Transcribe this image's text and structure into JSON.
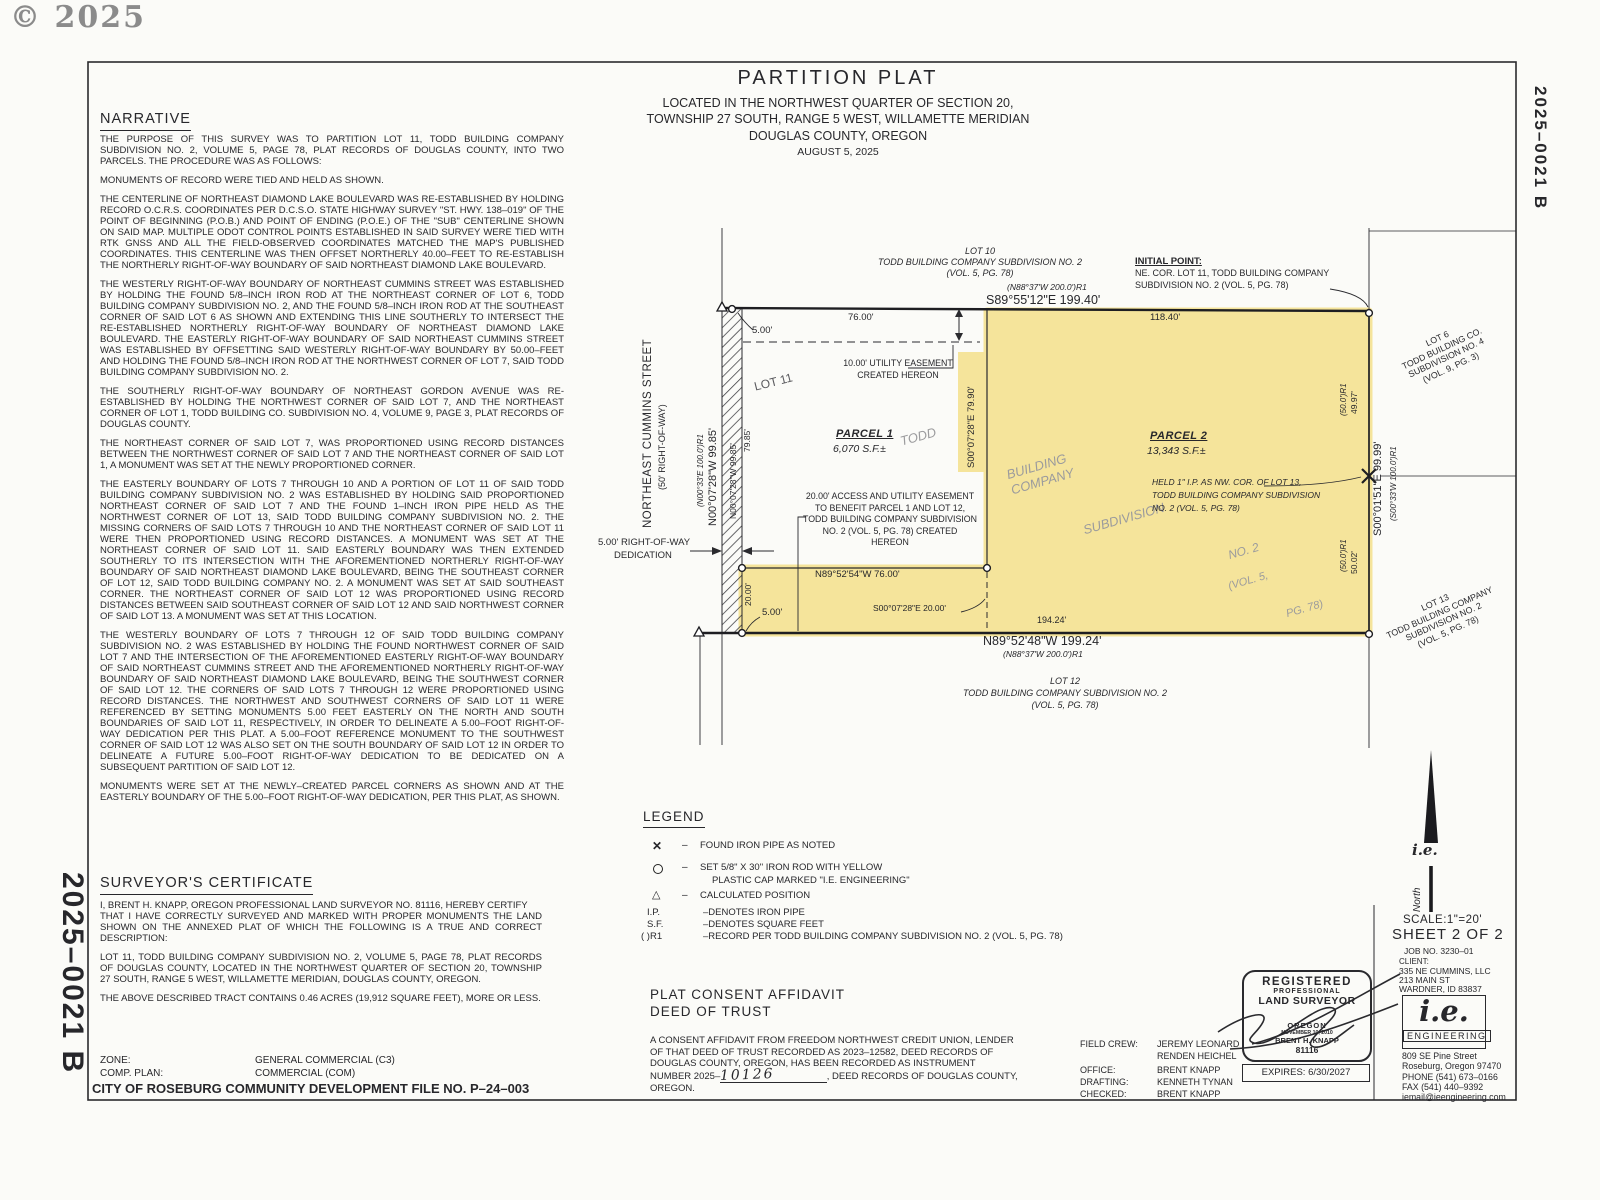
{
  "colors": {
    "highlight": "#f5e49b",
    "ink": "#27272b",
    "paper": "#fbfbf8",
    "watermark": "#9b9b9d"
  },
  "page": {
    "copyright": "© 2025",
    "doc_number_right": "2025–0021 B",
    "doc_number_left": "2025–0021 B"
  },
  "title": {
    "line1": "PARTITION  PLAT",
    "line2": "LOCATED  IN  THE  NORTHWEST  QUARTER  OF  SECTION  20,",
    "line3": "TOWNSHIP  27  SOUTH,  RANGE  5  WEST,  WILLAMETTE  MERIDIAN",
    "line4": "DOUGLAS  COUNTY,  OREGON",
    "date": "AUGUST  5,  2025"
  },
  "narrative": {
    "heading": "NARRATIVE",
    "paragraphs": [
      "THE PURPOSE OF THIS SURVEY WAS TO PARTITION LOT 11, TODD BUILDING COMPANY SUBDIVISION NO. 2, VOLUME 5, PAGE 78, PLAT RECORDS OF DOUGLAS COUNTY, INTO TWO PARCELS. THE PROCEDURE WAS AS FOLLOWS:",
      "MONUMENTS OF RECORD WERE TIED AND HELD AS SHOWN.",
      "THE CENTERLINE OF NORTHEAST DIAMOND LAKE BOULEVARD WAS RE-ESTABLISHED BY HOLDING RECORD O.C.R.S. COORDINATES PER D.C.S.O. STATE HIGHWAY SURVEY \"ST. HWY. 138–019\" OF THE POINT OF BEGINNING (P.O.B.) AND POINT OF ENDING (P.O.E.) OF THE \"SUB\" CENTERLINE SHOWN ON SAID MAP.  MULTIPLE ODOT CONTROL POINTS ESTABLISHED IN SAID SURVEY WERE TIED WITH RTK GNSS AND ALL THE FIELD-OBSERVED COORDINATES MATCHED THE MAP'S PUBLISHED COORDINATES.  THIS CENTERLINE WAS THEN OFFSET NORTHERLY 40.00–FEET TO RE-ESTABLISH THE NORTHERLY RIGHT-OF-WAY BOUNDARY OF SAID NORTHEAST DIAMOND LAKE BOULEVARD.",
      "THE WESTERLY RIGHT-OF-WAY BOUNDARY OF NORTHEAST CUMMINS STREET WAS ESTABLISHED BY HOLDING THE FOUND 5/8–INCH IRON ROD AT THE NORTHEAST CORNER OF LOT 6, TODD BUILDING COMPANY SUBDIVISION NO. 2, AND THE FOUND 5/8–INCH IRON ROD AT THE SOUTHEAST CORNER OF SAID LOT 6 AS SHOWN AND EXTENDING THIS LINE SOUTHERLY TO INTERSECT THE RE-ESTABLISHED NORTHERLY RIGHT-OF-WAY BOUNDARY OF NORTHEAST DIAMOND LAKE BOULEVARD.  THE EASTERLY RIGHT-OF-WAY BOUNDARY OF SAID NORTHEAST CUMMINS STREET WAS ESTABLISHED BY OFFSETTING SAID WESTERLY RIGHT-OF-WAY BOUNDARY BY 50.00–FEET AND HOLDING THE FOUND 5/8–INCH IRON ROD AT THE NORTHWEST CORNER OF LOT 7, SAID TODD BUILDING COMPANY SUBDIVISION NO. 2.",
      "THE SOUTHERLY RIGHT-OF-WAY BOUNDARY OF NORTHEAST GORDON AVENUE WAS RE-ESTABLISHED BY HOLDING THE NORTHWEST CORNER OF SAID LOT 7, AND THE NORTHEAST CORNER OF LOT 1, TODD BUILDING CO. SUBDIVISION NO. 4, VOLUME 9, PAGE 3, PLAT RECORDS OF DOUGLAS COUNTY.",
      "THE NORTHEAST CORNER OF SAID LOT 7, WAS PROPORTIONED USING RECORD DISTANCES BETWEEN THE NORTHWEST CORNER OF SAID LOT 7 AND THE NORTHEAST CORNER OF SAID LOT 1, A MONUMENT WAS SET AT THE NEWLY PROPORTIONED CORNER.",
      "THE EASTERLY BOUNDARY OF LOTS 7 THROUGH 10 AND A PORTION OF LOT 11 OF SAID TODD BUILDING COMPANY SUBDIVISION NO. 2 WAS ESTABLISHED BY HOLDING SAID PROPORTIONED NORTHEAST CORNER OF SAID LOT 7 AND THE FOUND 1–INCH IRON PIPE HELD AS THE NORTHWEST CORNER OF LOT 13, SAID TODD BUILDING COMPANY SUBDIVISION NO. 2.  THE MISSING CORNERS OF SAID LOTS 7 THROUGH 10 AND THE NORTHEAST CORNER OF SAID LOT 11 WERE THEN PROPORTIONED USING RECORD DISTANCES.  A MONUMENT WAS SET AT THE NORTHEAST CORNER OF SAID LOT 11.  SAID EASTERLY BOUNDARY WAS THEN EXTENDED SOUTHERLY TO ITS INTERSECTION WITH THE AFOREMENTIONED NORTHERLY RIGHT-OF-WAY BOUNDARY OF SAID NORTHEAST DIAMOND LAKE BOULEVARD, BEING THE SOUTHEAST CORNER OF LOT 12, SAID TODD BUILDING COMPANY NO. 2.  A MONUMENT WAS SET AT SAID SOUTHEAST CORNER.  THE NORTHEAST CORNER OF SAID LOT 12 WAS PROPORTIONED USING RECORD DISTANCES BETWEEN SAID SOUTHEAST CORNER OF SAID LOT 12 AND SAID NORTHWEST CORNER OF SAID LOT 13.  A MONUMENT WAS SET AT THIS LOCATION.",
      "THE WESTERLY BOUNDARY OF LOTS 7 THROUGH 12 OF SAID TODD BUILDING COMPANY SUBDIVISION NO. 2 WAS ESTABLISHED BY HOLDING THE FOUND NORTHWEST CORNER OF SAID LOT 7 AND THE INTERSECTION OF THE AFOREMENTIONED EASTERLY RIGHT-OF-WAY BOUNDARY OF SAID NORTHEAST CUMMINS STREET AND THE AFOREMENTIONED NORTHERLY RIGHT-OF-WAY BOUNDARY OF SAID NORTHEAST DIAMOND LAKE BOULEVARD, BEING THE SOUTHWEST CORNER OF SAID LOT 12.  THE CORNERS OF SAID LOTS 7 THROUGH 12 WERE PROPORTIONED USING RECORD DISTANCES.  THE NORTHWEST AND SOUTHWEST CORNERS OF SAID LOT 11 WERE REFERENCED BY SETTING MONUMENTS 5.00 FEET EASTERLY ON THE NORTH AND SOUTH BOUNDARIES OF SAID LOT 11, RESPECTIVELY, IN ORDER TO DELINEATE A 5.00–FOOT RIGHT-OF-WAY DEDICATION PER THIS PLAT.  A 5.00–FOOT REFERENCE MONUMENT TO THE SOUTHWEST CORNER OF SAID LOT 12 WAS ALSO SET ON THE SOUTH BOUNDARY OF SAID LOT 12 IN ORDER TO DELINEATE A FUTURE 5.00–FOOT RIGHT-OF-WAY DEDICATION TO BE DEDICATED ON A SUBSEQUENT PARTITION OF SAID LOT 12.",
      "MONUMENTS WERE SET AT THE NEWLY–CREATED PARCEL CORNERS AS SHOWN AND AT THE EASTERLY BOUNDARY OF THE 5.00–FOOT RIGHT-OF-WAY DEDICATION, PER THIS PLAT, AS SHOWN."
    ]
  },
  "certificate": {
    "heading": "SURVEYOR'S  CERTIFICATE",
    "p1": "I, BRENT H. KNAPP, OREGON PROFESSIONAL LAND SURVEYOR NO. 81116, HEREBY CERTIFY",
    "p2": "THAT I HAVE CORRECTLY SURVEYED AND MARKED WITH PROPER MONUMENTS THE LAND SHOWN ON THE ANNEXED PLAT OF WHICH THE FOLLOWING IS A TRUE AND CORRECT DESCRIPTION:",
    "p3": "LOT 11, TODD BUILDING COMPANY SUBDIVISION NO. 2, VOLUME 5, PAGE 78, PLAT RECORDS OF DOUGLAS COUNTY, LOCATED IN THE NORTHWEST QUARTER OF SECTION 20, TOWNSHIP 27 SOUTH, RANGE 5 WEST, WILLAMETTE MERIDIAN, DOUGLAS COUNTY, OREGON.",
    "p4": "THE ABOVE DESCRIBED TRACT CONTAINS 0.46 ACRES (19,912 SQUARE FEET), MORE OR LESS."
  },
  "zoning": {
    "zone_label": "ZONE:",
    "zone_value": "GENERAL  COMMERCIAL  (C3)",
    "comp_label": "COMP. PLAN:",
    "comp_value": "COMMERCIAL  (COM)",
    "city_file": "CITY  OF  ROSEBURG  COMMUNITY  DEVELOPMENT  FILE  NO.  P–24–003"
  },
  "legend": {
    "heading": "LEGEND",
    "dash": "–",
    "found_pipe": "FOUND  IRON  PIPE  AS  NOTED",
    "set_rod_1": "SET  5/8\"  X  30\"  IRON  ROD  WITH  YELLOW",
    "set_rod_2": "PLASTIC  CAP  MARKED  \"I.E.  ENGINEERING\"",
    "calculated": "CALCULATED  POSITION",
    "ip_abbr": "I.P.",
    "ip_text": "–DENOTES  IRON  PIPE",
    "sf_abbr": "S.F.",
    "sf_text": "–DENOTES  SQUARE  FEET",
    "r1_abbr": "(   )R1",
    "r1_text": "–RECORD  PER  TODD  BUILDING  COMPANY  SUBDIVISION  NO.  2  (VOL.  5,  PG.  78)"
  },
  "affidavit": {
    "heading1": "PLAT  CONSENT  AFFIDAVIT",
    "heading2": "DEED  OF  TRUST",
    "line1": "A CONSENT AFFIDAVIT FROM FREEDOM NORTHWEST CREDIT UNION, LENDER",
    "line2": "OF THAT DEED OF TRUST RECORDED AS 2023–12582, DEED RECORDS OF",
    "line3": "DOUGLAS COUNTY, OREGON, HAS BEEN RECORDED AS INSTRUMENT",
    "line4a": "NUMBER 2025–",
    "handwritten": "10126",
    "line4b": ", DEED RECORDS OF DOUGLAS COUNTY,",
    "line5": "OREGON."
  },
  "credits": {
    "field_crew_label": "FIELD CREW:",
    "field_crew_1": "JEREMY  LEONARD",
    "field_crew_2": "RENDEN  HEICHEL",
    "office_label": "OFFICE:",
    "office": "BRENT  KNAPP",
    "drafting_label": "DRAFTING:",
    "drafting": "KENNETH  TYNAN",
    "checked_label": "CHECKED:",
    "checked": "BRENT  KNAPP"
  },
  "stamp": {
    "registered": "REGISTERED",
    "professional": "PROFESSIONAL",
    "land_surveyor": "LAND SURVEYOR",
    "state": "OREGON",
    "date": "NOVEMBER 10, 2010",
    "name": "BRENT H. KNAPP",
    "number": "81116",
    "expires": "EXPIRES:   6/30/2027"
  },
  "titleblock": {
    "north": "North",
    "north_logo": "i.e.",
    "scale": "SCALE:1\"=20'",
    "sheet": "SHEET  2  OF  2",
    "job": "JOB  NO.   3230–01",
    "client_label": "CLIENT:",
    "client1": "335 NE CUMMINS, LLC",
    "client2": "213 MAIN ST",
    "client3": "WARDNER, ID 83837",
    "logo_ie": "i.e.",
    "logo_eng": "ENGINEERING",
    "addr1": "809 SE Pine Street",
    "addr2": "Roseburg, Oregon 97470",
    "addr3": "PHONE (541) 673–0166",
    "addr4": "FAX (541) 440–9392",
    "addr5": "iemail@ieengineering.com"
  },
  "plat": {
    "lot10_1": "LOT 10",
    "lot10_2": "TODD BUILDING COMPANY SUBDIVISION NO. 2",
    "lot10_3": "(VOL. 5, PG. 78)",
    "record_top": "(N88°37'W 200.0')R1",
    "bearing_top": "S89°55'12\"E  199.40'",
    "initial_point_1": "INITIAL  POINT:",
    "initial_point_2": "NE. COR. LOT 11, TODD BUILDING COMPANY",
    "initial_point_3": "SUBDIVISION NO. 2 (VOL. 5, PG. 78)",
    "dim_76": "76.00'",
    "dim_118": "118.40'",
    "dim_5_top": "5.00'",
    "lot11": "LOT 11",
    "easement10_1": "10.00'  UTILITY  EASEMENT",
    "easement10_2": "CREATED  HEREON",
    "parcel1_name": "PARCEL  1",
    "parcel1_area": "6,070  S.F.±",
    "parcel2_name": "PARCEL  2",
    "parcel2_area": "13,343  S.F.±",
    "divider_bearing": "S00°07'28\"E  79.90'",
    "wm_todd": "TODD",
    "wm_building": "BUILDING",
    "wm_company": "COMPANY",
    "wm_subdivision": "SUBDIVISION",
    "wm_no2": "NO.  2",
    "wm_vol": "(VOL.  5,",
    "wm_pg": "PG.  78)",
    "held_1": "HELD 1\" I.P. AS NW. COR. OF LOT 13,",
    "held_2": "TODD BUILDING COMPANY SUBDIVISION",
    "held_3": "NO. 2 (VOL. 5, PG. 78)",
    "easement20_1": "20.00' ACCESS AND UTILITY EASEMENT",
    "easement20_2": "TO BENEFIT PARCEL 1 AND LOT 12,",
    "easement20_3": "TODD BUILDING COMPANY SUBDIVISION",
    "easement20_4": "NO. 2 (VOL. 5, PG. 78) CREATED",
    "easement20_5": "HEREON",
    "bearing_76": "N89°52'54\"W  76.00'",
    "bearing_20": "S00°07'28\"E  20.00'",
    "dim_20": "20.00'",
    "dim_5_bottom": "5.00'",
    "dim_194": "194.24'",
    "bearing_bottom": "N89°52'48\"W  199.24'",
    "record_bottom": "(N88°37'W 200.0')R1",
    "lot12_1": "LOT 12",
    "lot12_2": "TODD BUILDING COMPANY SUBDIVISION NO. 2",
    "lot12_3": "(VOL. 5, PG. 78)",
    "street_1": "NORTHEAST  CUMMINS  STREET",
    "street_2": "(50'  RIGHT-OF-WAY)",
    "record_west": "(N00°33'E 100.0')R1",
    "bearing_west": "N00°07'28\"W  99.85'",
    "bearing_west2": "N00°07'28\"W 99.85'",
    "dim_79": "79.85'",
    "row_dedication_1": "5.00'  RIGHT-OF-WAY",
    "row_dedication_2": "DEDICATION",
    "record_50_1": "(50.0')R1",
    "dim_49": "49.97'",
    "record_50_2": "(50.0')R1",
    "dim_50": "50.02'",
    "bearing_east": "S00°01'51\"E  99.99'",
    "record_east": "(S00°33'W 100.0')R1",
    "lot6_1": "LOT 6",
    "lot6_2": "TODD BUILDING CO.",
    "lot6_3": "SUBDIVISION NO. 4",
    "lot6_4": "(VOL. 9, PG. 3)",
    "lot13_1": "LOT 13",
    "lot13_2": "TODD BUILDING COMPANY",
    "lot13_3": "SUBDIVISION NO. 2",
    "lot13_4": "(VOL. 5, PG. 78)"
  }
}
